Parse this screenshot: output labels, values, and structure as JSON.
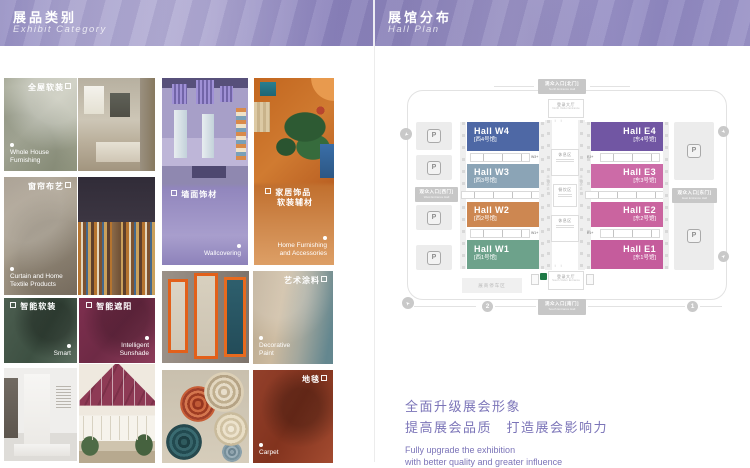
{
  "headers": {
    "left": {
      "zh": "展品类别",
      "en": "Exhibit  Category"
    },
    "right": {
      "zh": "展馆分布",
      "en": "Hall Plan"
    }
  },
  "colors": {
    "brand_purple": "#968fc4",
    "tagline_purple": "#7b74b8"
  },
  "categories": {
    "whole_house": {
      "zh": "全屋软装",
      "en": "Whole House Furnishing"
    },
    "curtain": {
      "zh": "窗帘布艺",
      "en": "Curtain and Home Textile Products"
    },
    "wallcovering": {
      "zh": "墙面饰材",
      "en": "Wallcovering"
    },
    "home_furnishing": {
      "zh": "家居饰品",
      "zh2": "软装辅材",
      "en": "Home Furnishing and Accessories"
    },
    "smart": {
      "zh": "智能软装",
      "en": "Smart"
    },
    "sunshade": {
      "zh": "智能遮阳",
      "en": "Intelligent Sunshade"
    },
    "decorative_paint": {
      "zh": "艺术涂料",
      "en": "Decorative Paint"
    },
    "carpet": {
      "zh": "地毯",
      "en": "Carpet"
    }
  },
  "hall_plan": {
    "halls": [
      {
        "name": "Hall W4",
        "sub": "[西4号馆]",
        "color": "#4e68a5"
      },
      {
        "name": "Hall W3",
        "sub": "[西3号馆]",
        "color": "#8ba4b6"
      },
      {
        "name": "Hall W2",
        "sub": "[西2号馆]",
        "color": "#cd8751"
      },
      {
        "name": "Hall W1",
        "sub": "[西1号馆]",
        "color": "#6da28b"
      },
      {
        "name": "Hall E4",
        "sub": "[东4号馆]",
        "color": "#7156a3"
      },
      {
        "name": "Hall E3",
        "sub": "[东3号馆]",
        "color": "#cc6ba7"
      },
      {
        "name": "Hall E2",
        "sub": "[东2号馆]",
        "color": "#ca649f"
      },
      {
        "name": "Hall E1",
        "sub": "[东1号馆]",
        "color": "#c55c9c"
      }
    ],
    "corridor_labels": {
      "w3": "W3+",
      "w1": "W1+",
      "e3": "E3+",
      "e1": "E1+"
    },
    "entrances": {
      "north": {
        "zh": "观众入口[北门]",
        "en": "North Entrance Hall"
      },
      "south": {
        "zh": "观众入口[南门]",
        "en": "South Entrance Hall"
      },
      "west": {
        "zh": "观众入口[西门]",
        "en": "West Entrance Hall"
      },
      "east": {
        "zh": "观众入口[东门]",
        "en": "East Entrance Hall"
      }
    },
    "facilities": {
      "lobby_north": {
        "zh": "登录大厅",
        "en": "North Visitor Entrance"
      },
      "lobby_south": {
        "zh": "登录大厅",
        "en": "South Visitor Entrance"
      },
      "rest_area": "休息区",
      "canteen": "餐饮区",
      "fire_lane": "消防通道",
      "exhibitor_parking": "展商停车区",
      "parking": "P"
    },
    "markers": {
      "gate_1": "1",
      "gate_2": "2",
      "arrow_glyph": "➤"
    }
  },
  "tagline": {
    "zh1": "全面升级展会形象",
    "zh2": "提高展会品质　打造展会影响力",
    "en1": "Fully upgrade the exhibition",
    "en2": "with better quality and greater influence"
  }
}
